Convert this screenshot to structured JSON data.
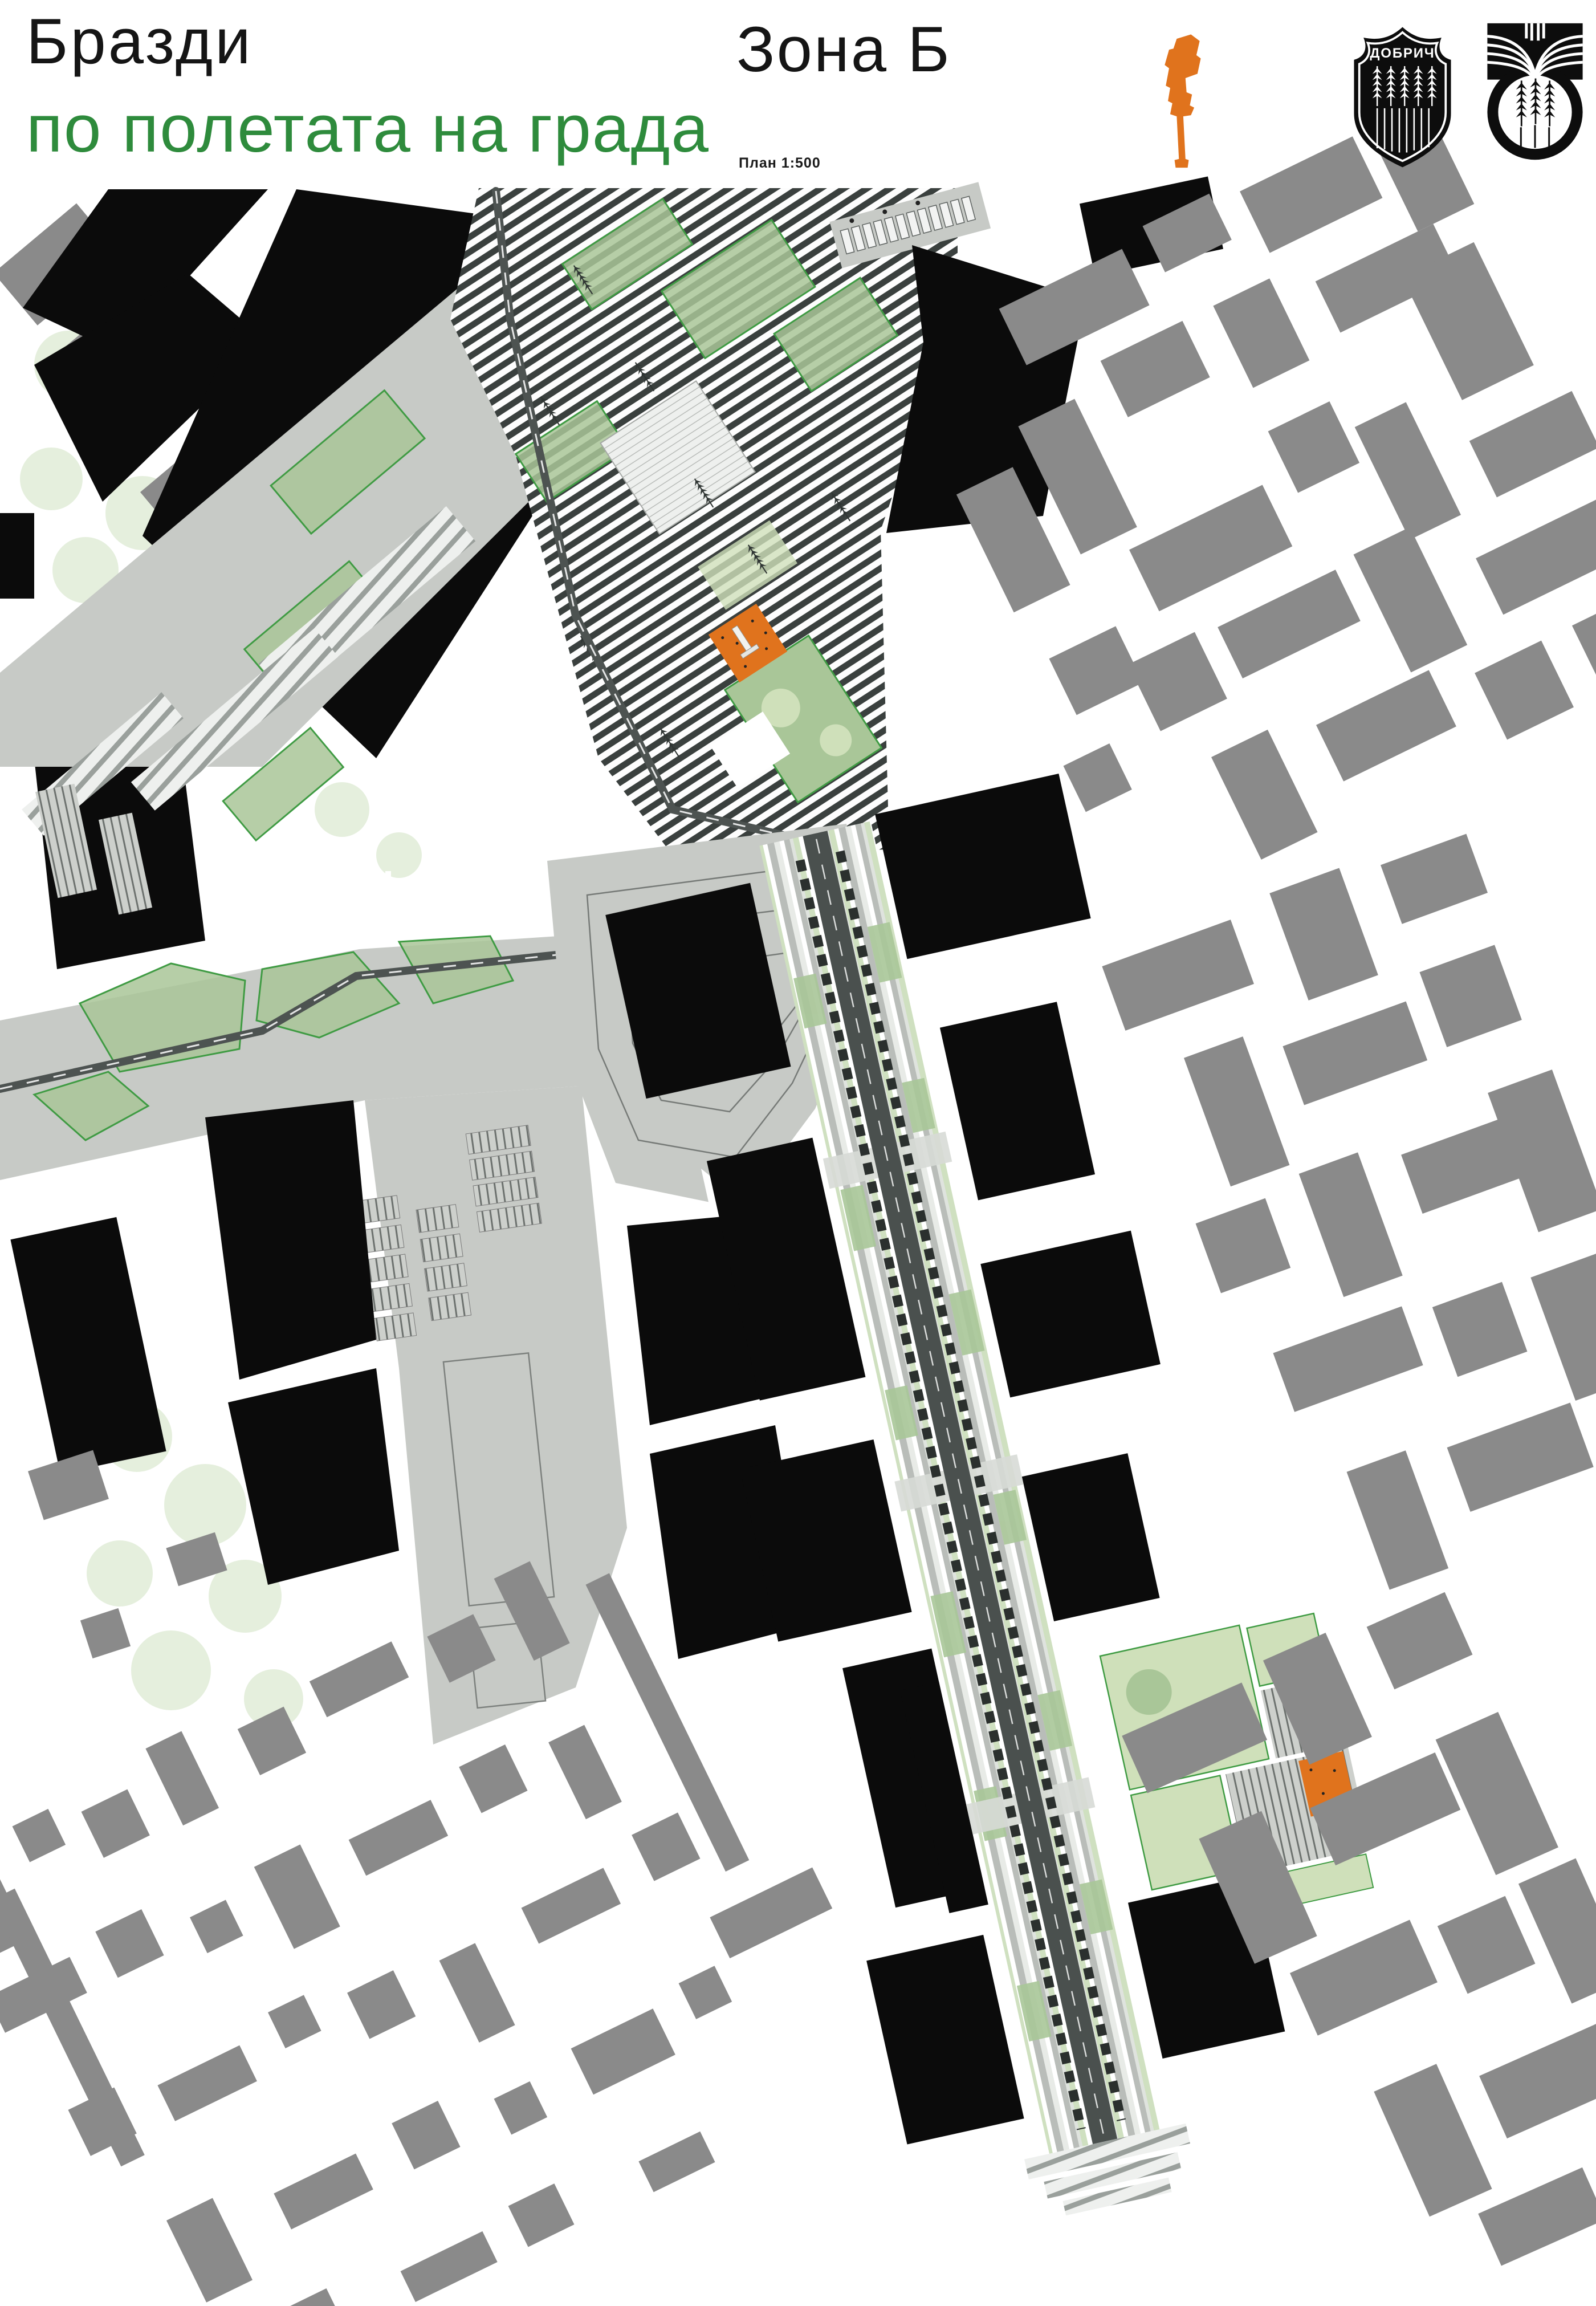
{
  "poster": {
    "title_black": "Бразди",
    "title_green": "по полетата на града",
    "zone_label": "Зона Б",
    "scale_note": "План 1:500",
    "emblem_city_name": "ДОБРИЧ"
  },
  "icons": {
    "keyplan": "orange-keyplan-silhouette-icon",
    "coat_of_arms": "dobrich-coat-of-arms-icon",
    "wheat_emblem": "wheat-circle-emblem-icon"
  },
  "colors": {
    "title_green": "#2e8b3c",
    "accent_orange": "#e0731d",
    "building_gray": "#8a8a8a",
    "paving_gray": "#c7cac6",
    "stripe_dark": "#3a403e",
    "green_light": "#cfe0ba",
    "green_mid": "#a9c698",
    "green_border": "#3f9b43",
    "ink_black": "#0b0b0b",
    "road_dark": "#4d5351",
    "pale_tree": "#dcead2"
  }
}
